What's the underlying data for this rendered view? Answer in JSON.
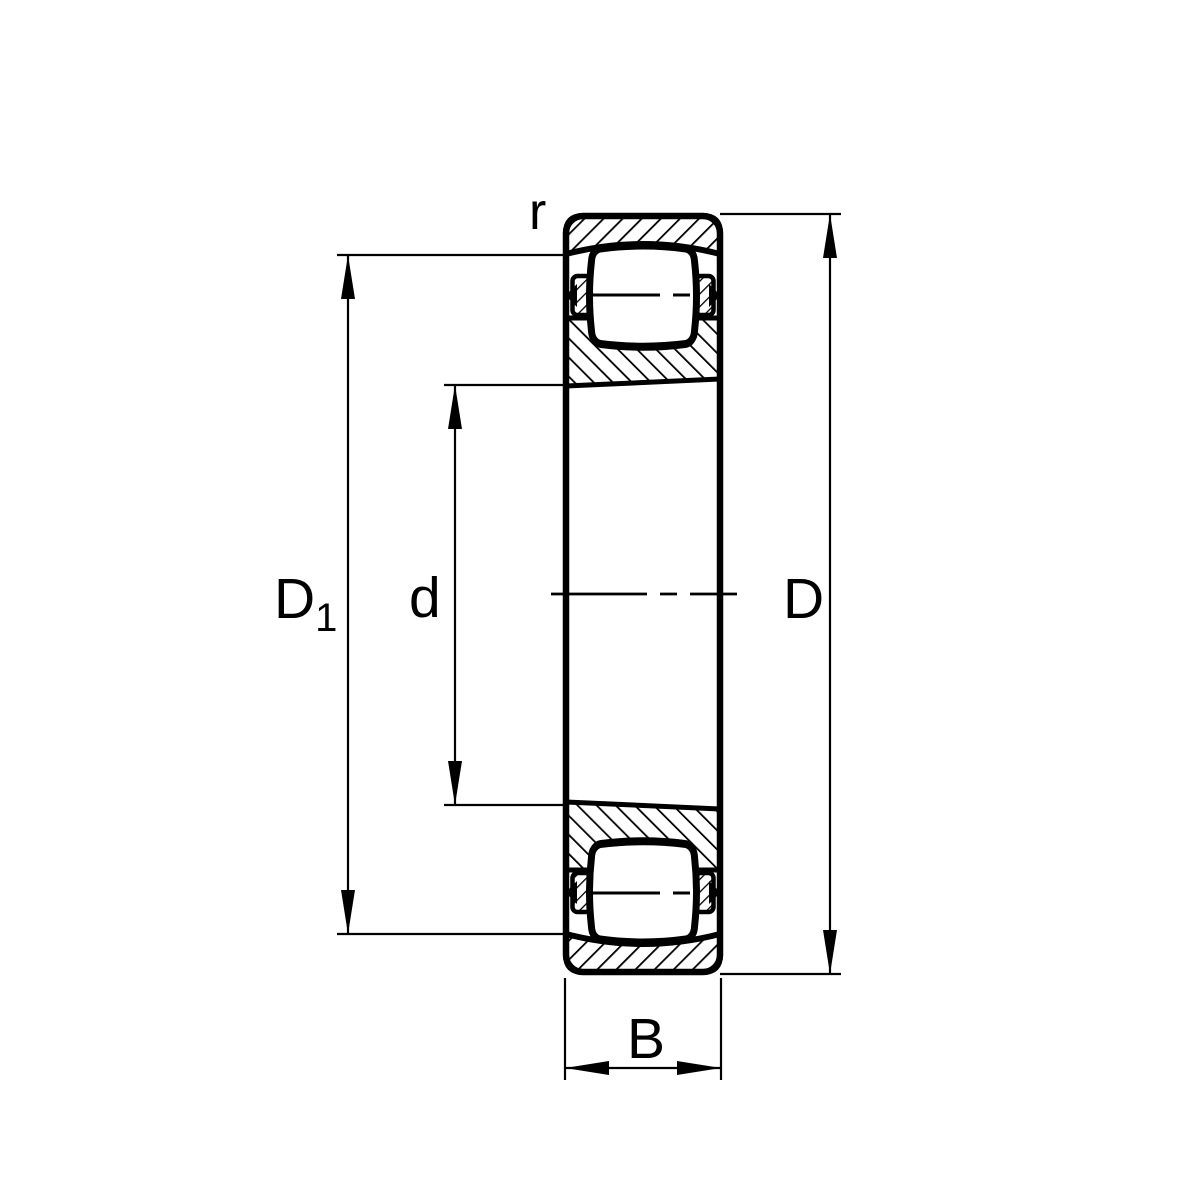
{
  "drawing": {
    "labels": {
      "r": "r",
      "d1_base": "D",
      "d1_sub": "1",
      "d": "d",
      "D": "D",
      "B": "B"
    },
    "colors": {
      "line": "#000000",
      "background": "#ffffff"
    }
  }
}
